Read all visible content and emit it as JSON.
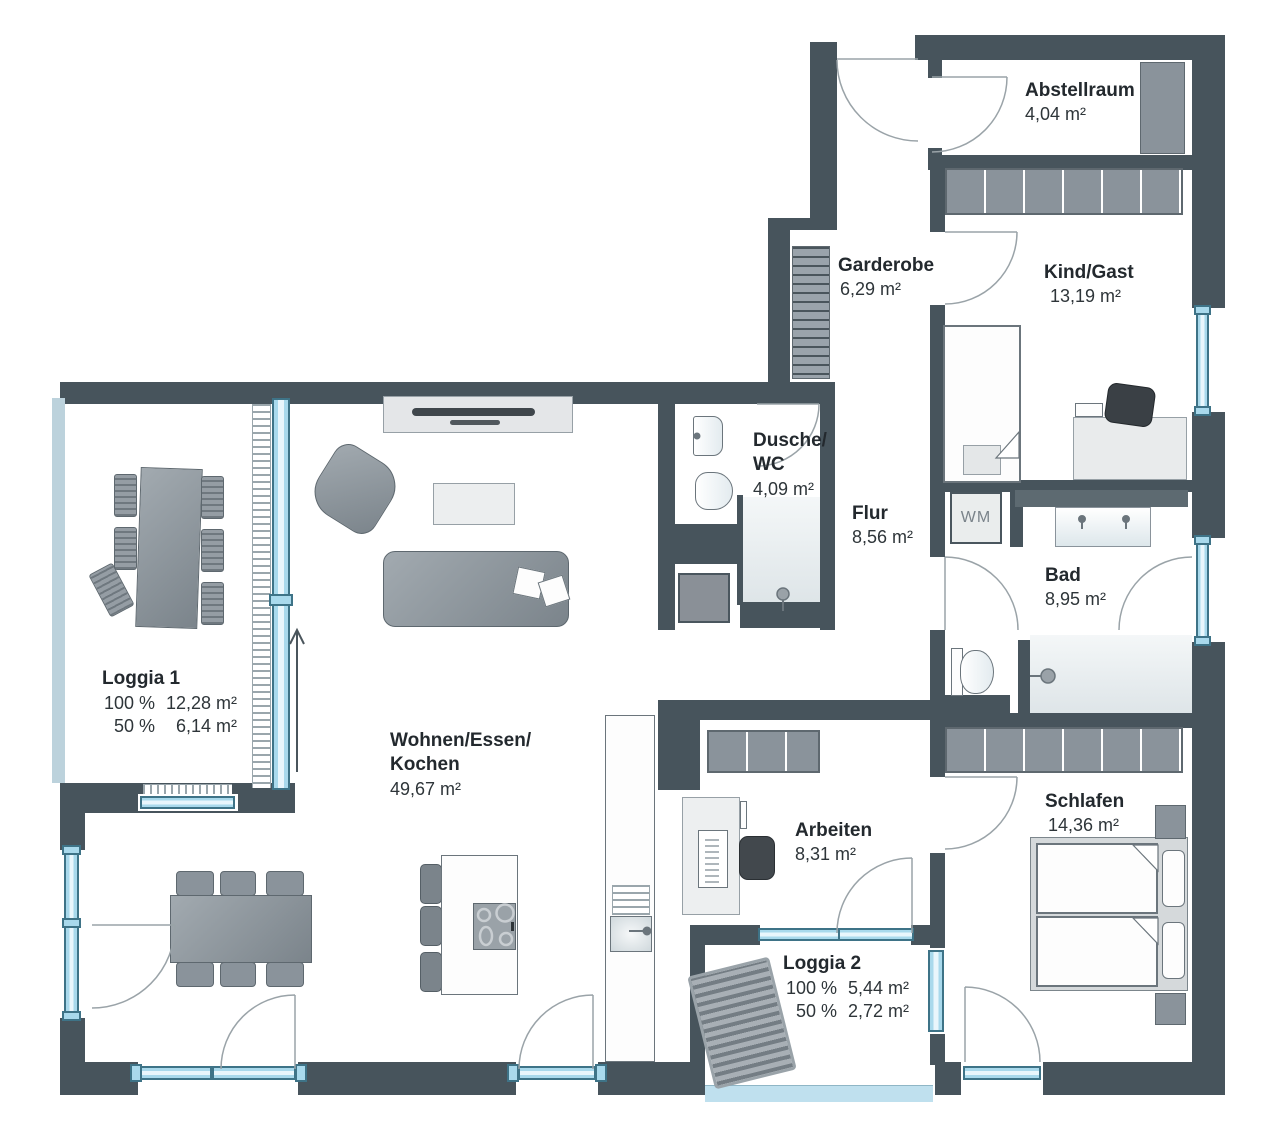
{
  "rooms": {
    "abstellraum": {
      "name": "Abstellraum",
      "area": "4,04 m²"
    },
    "garderobe": {
      "name": "Garderobe",
      "area": "6,29 m²"
    },
    "kind_gast": {
      "name": "Kind/Gast",
      "area": "13,19 m²"
    },
    "dusche_wc": {
      "name_line1": "Dusche/",
      "name_line2": "WC",
      "area": "4,09 m²"
    },
    "flur": {
      "name": "Flur",
      "area": "8,56 m²"
    },
    "bad": {
      "name": "Bad",
      "area": "8,95 m²"
    },
    "wohnen": {
      "name_line1": "Wohnen/Essen/",
      "name_line2": "Kochen",
      "area": "49,67 m²"
    },
    "arbeiten": {
      "name": "Arbeiten",
      "area": "8,31 m²"
    },
    "schlafen": {
      "name": "Schlafen",
      "area": "14,36 m²"
    },
    "loggia1": {
      "name": "Loggia 1",
      "rows": [
        {
          "pct": "100 %",
          "area": "12,28 m²"
        },
        {
          "pct": "50 %",
          "area": "6,14 m²"
        }
      ]
    },
    "loggia2": {
      "name": "Loggia 2",
      "rows": [
        {
          "pct": "100 %",
          "area": "5,44 m²"
        },
        {
          "pct": "50 %",
          "area": "2,72 m²"
        }
      ]
    }
  },
  "appliances": {
    "washing_machine": "WM"
  },
  "colors": {
    "wall": "#47545C",
    "window": "#A9D9EC",
    "window_frame": "#3E7387",
    "furniture": "#8A939B",
    "rail": "#BCD2DC",
    "text": "#23292E"
  }
}
